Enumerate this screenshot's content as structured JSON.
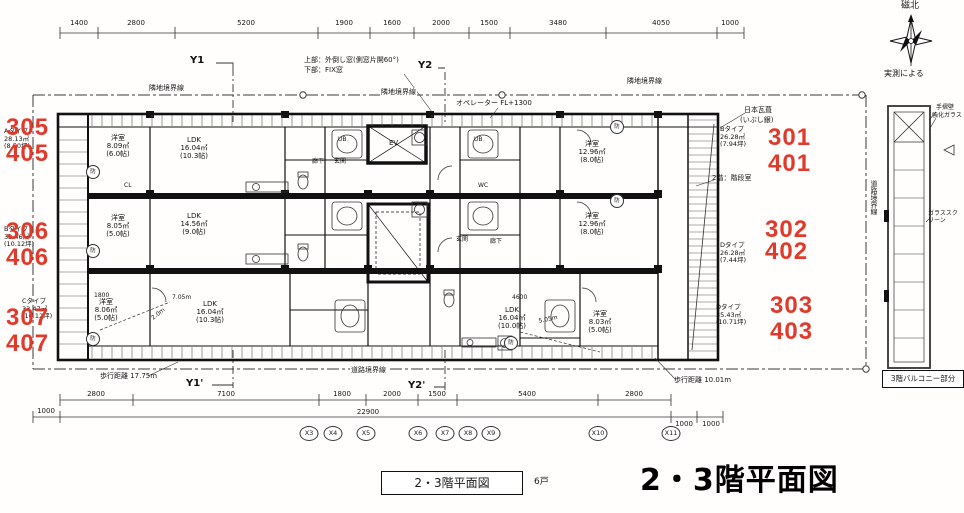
{
  "page": {
    "title_big": "2・3階平面図",
    "title_box": "2・3階平面図",
    "unit_count": "6戸"
  },
  "compass": {
    "north": "磁北",
    "by_survey": "実測による"
  },
  "markers": {
    "y1": "Y1",
    "y2": "Y2",
    "y1p": "Y1'",
    "y2p": "Y2'"
  },
  "boundaries": {
    "top_left": "隣地境界線",
    "top_mid": "隣地境界線",
    "top_right": "隣地境界線",
    "bottom": "道路境界線",
    "right": "道路境界線"
  },
  "dimensions": {
    "top": [
      "1400",
      "2800",
      "5200",
      "1900",
      "1600",
      "2000",
      "1500",
      "3480",
      "4050",
      "1000"
    ],
    "bottom": [
      "2800",
      "7100",
      "1800",
      "2000",
      "1500",
      "5400",
      "2800"
    ],
    "total": "22900",
    "left_end": "1000",
    "right_end1": "1000",
    "right_end2": "1000"
  },
  "grid_bubbles": [
    "X3",
    "X4",
    "X5",
    "X6",
    "X7",
    "X8",
    "X9",
    "X10",
    "X11"
  ],
  "units": [
    {
      "upper": "301",
      "lower": "401",
      "type": "Bタイプ",
      "area": "26.28㎡",
      "tsubo": "(7.94坪)"
    },
    {
      "upper": "302",
      "lower": "402",
      "type": "Dタイプ",
      "area": "26.28㎡",
      "tsubo": "(7.44坪)"
    },
    {
      "upper": "303",
      "lower": "403",
      "type": "Dタイプ",
      "area": "35.43㎡",
      "tsubo": "(10.71坪)"
    },
    {
      "upper": "305",
      "lower": "405",
      "type": "Aタイプ",
      "area": "28.13㎡",
      "tsubo": "(8.50坪)"
    },
    {
      "upper": "306",
      "lower": "406",
      "type": "Bタイプ",
      "area": "33.46㎡",
      "tsubo": "(10.12坪)"
    },
    {
      "upper": "307",
      "lower": "407",
      "type": "Cタイプ",
      "area": "33.47㎡",
      "tsubo": "(10.12坪)"
    }
  ],
  "rooms": [
    {
      "name": "洋室",
      "area": "8.09㎡",
      "size": "(6.0帖)"
    },
    {
      "name": "LDK",
      "area": "16.04㎡",
      "size": "(10.3帖)"
    },
    {
      "name": "洋室",
      "area": "12.96㎡",
      "size": "(8.0帖)"
    },
    {
      "name": "洋室",
      "area": "8.05㎡",
      "size": "(5.0帖)"
    },
    {
      "name": "LDK",
      "area": "14.56㎡",
      "size": "(9.0帖)"
    },
    {
      "name": "洋室",
      "area": "12.96㎡",
      "size": "(8.0帖)"
    },
    {
      "name": "洋室",
      "area": "8.06㎡",
      "size": "(5.0帖)"
    },
    {
      "name": "LDK",
      "area": "16.04㎡",
      "size": "(10.3帖)"
    },
    {
      "name": "LDK",
      "area": "16.04㎡",
      "size": "(10.0帖)"
    },
    {
      "name": "洋室",
      "area": "8.03㎡",
      "size": "(5.0帖)"
    }
  ],
  "core": {
    "ev": "EV",
    "ub": "UB",
    "wc": "WC",
    "cl": "CL",
    "genkan": "玄関",
    "roka": "廊下",
    "mark": "防"
  },
  "annotations": {
    "window_top": "上部：外倒し窓(側窓片開60°)",
    "window_bottom": "下部：FIX窓",
    "operator": "オペレーター FL+1300",
    "roof_material": "日本瓦葺",
    "roof_finish": "(いぶし銀)",
    "stair_note": "2階：階段室",
    "walk_left": "歩行距離 17.75m",
    "walk_right": "歩行距離 10.01m",
    "balcony_box": "3階バルコニー部分",
    "handrail_1": "手摺壁",
    "handrail_2": "強化ガラス",
    "glass_screen": "ガラススクリーン",
    "dist_a": "2.0m",
    "dist_b": "7.05m",
    "dist_c": "5.05m",
    "dim_a": "1800",
    "dim_b": "4600"
  }
}
